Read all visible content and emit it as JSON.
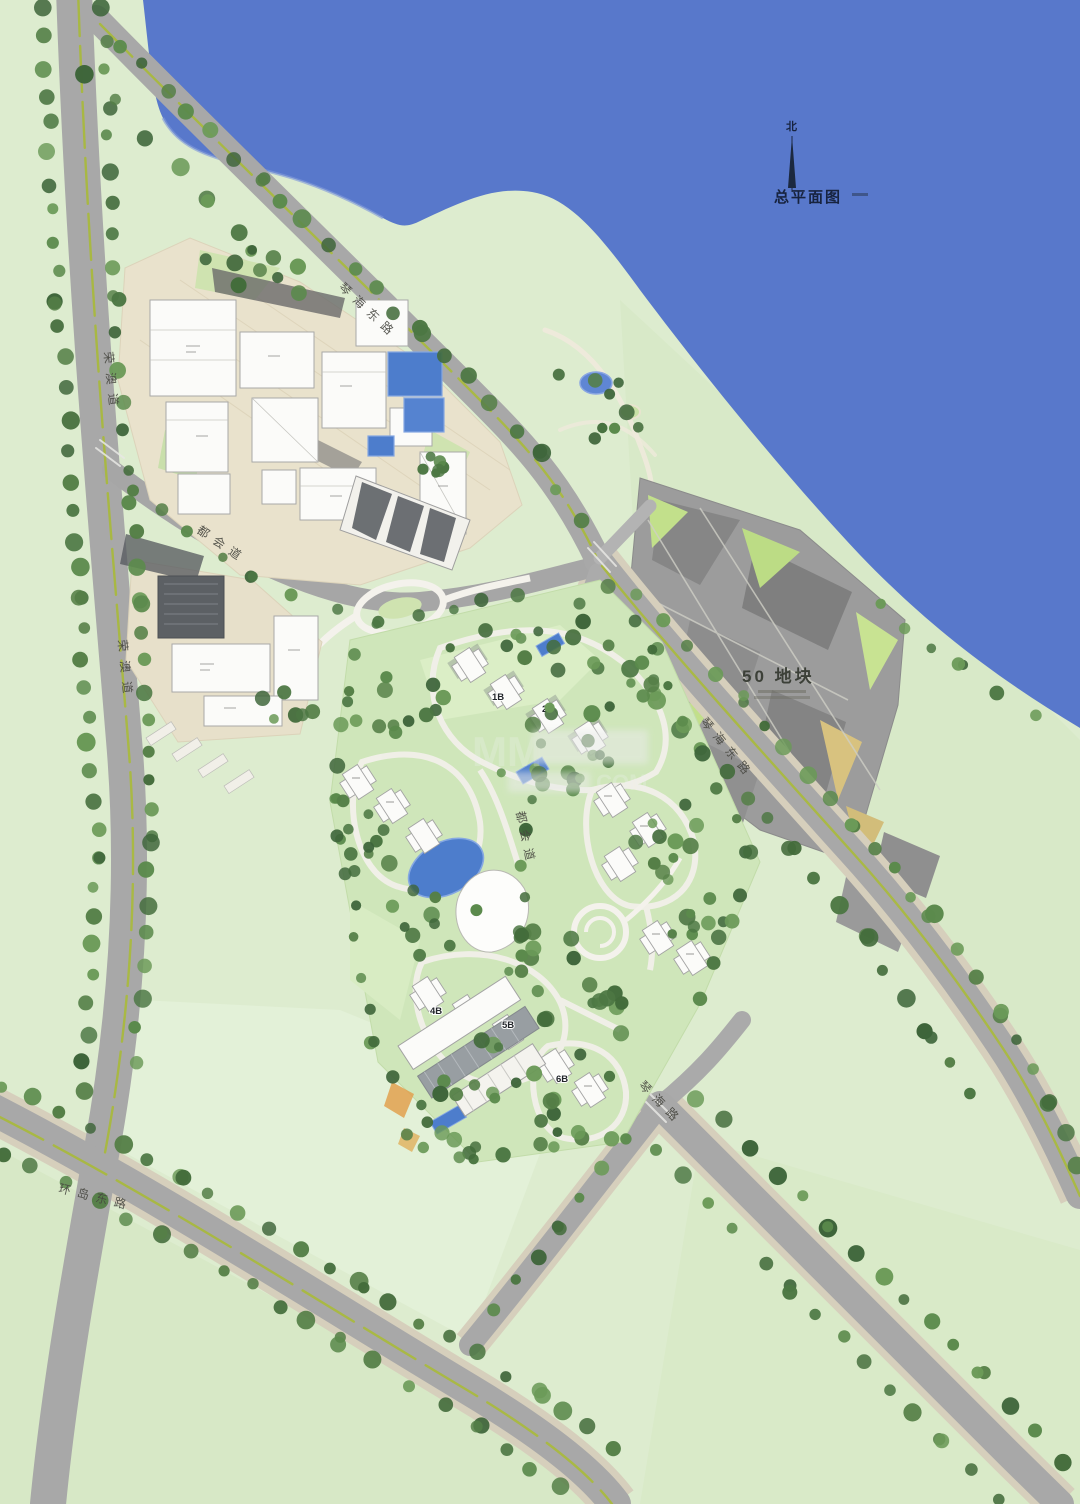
{
  "map": {
    "title_block": {
      "north_char": "北",
      "title": "总平面图"
    },
    "labels": {
      "plot50": "50 地块",
      "road_qinhai_top": "琴海东路",
      "road_qinhai_right": "琴海东路",
      "road_qinhai_south": "琴海路",
      "road_rongao_upper": "荣澳道",
      "road_rongao_lower": "荣澳道",
      "road_duhui_upper": "都会道",
      "road_duhui_central": "都会道",
      "road_huandao_east": "环岛东路"
    },
    "building_labels": {
      "b1": "1B",
      "b2": "2B",
      "b4": "4B",
      "b5": "5B",
      "b6": "6B"
    },
    "watermark": {
      "left": "MM",
      "right": ".COM"
    },
    "colors": {
      "water": "#5878cb",
      "land": "#ddeccf",
      "residential_ground": "#cfe6ba",
      "road": "#a8a8a8",
      "road_median": "#a9b93e",
      "sidewalk": "#d6cfbc",
      "plaza": "#e9e2cc",
      "building_white": "#fbfbf9",
      "building_dark": "#5c6064",
      "plot50_gray": "#9c9c9c",
      "pool_blue": "#4d7dcc",
      "tree_green": "#4c7743"
    }
  }
}
